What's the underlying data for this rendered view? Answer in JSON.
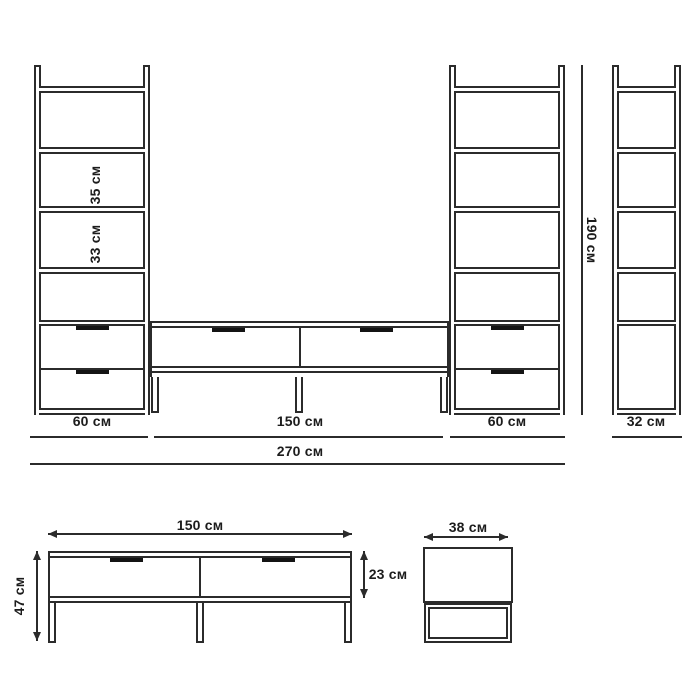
{
  "colors": {
    "line": "#2b2b2b",
    "text": "#1c1c1c",
    "handle": "#141414",
    "background": "#ffffff"
  },
  "wall_unit": {
    "left_column": {
      "width_label": "60 см",
      "shelf_spacings": [
        {
          "label": "35 см"
        },
        {
          "label": "33 см"
        }
      ]
    },
    "tv_bench": {
      "width_label": "150 см"
    },
    "right_column": {
      "width_label": "60 см"
    },
    "side_profile": {
      "depth_label": "32 см"
    },
    "total_width_label": "270 см",
    "height_label": "190 см"
  },
  "bench_front": {
    "width_label": "150 см",
    "height_label": "47 см",
    "drawer_height_label": "23 см"
  },
  "bench_side": {
    "depth_label": "38 см"
  }
}
